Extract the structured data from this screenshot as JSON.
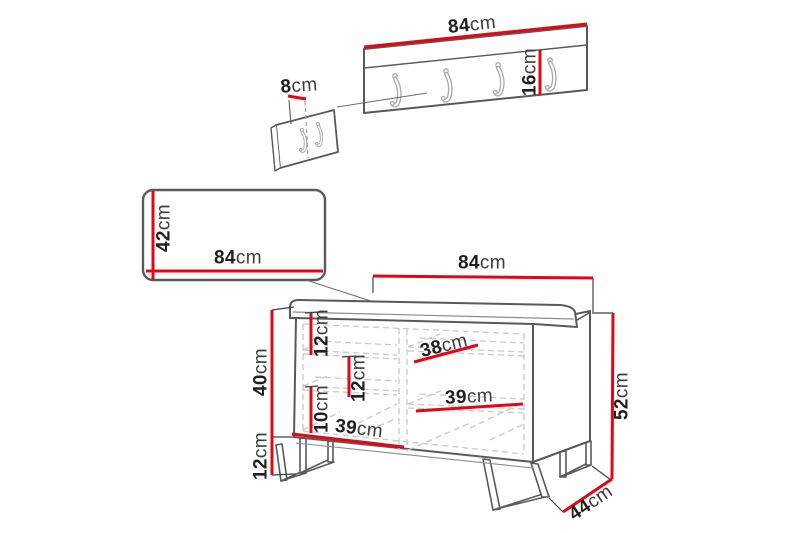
{
  "figure": {
    "description": "Hallway furniture set dimension diagram: wall coat rack, wall panel and shoe bench",
    "colors": {
      "dimension_line": "#e30613",
      "outline": "#58595b",
      "hidden_line": "#c7c8ca",
      "text": "#231f20"
    },
    "unit": "cm"
  },
  "labels": {
    "rack_width": {
      "value": "84",
      "unit": "cm"
    },
    "rack_height": {
      "value": "16",
      "unit": "cm"
    },
    "rack_depth": {
      "value": "8",
      "unit": "cm"
    },
    "mirror_height": {
      "value": "42",
      "unit": "cm"
    },
    "mirror_width": {
      "value": "84",
      "unit": "cm"
    },
    "bench_width": {
      "value": "84",
      "unit": "cm"
    },
    "bench_height": {
      "value": "52",
      "unit": "cm"
    },
    "bench_depth": {
      "value": "44",
      "unit": "cm"
    },
    "bench_body_height": {
      "value": "40",
      "unit": "cm"
    },
    "bench_leg_height": {
      "value": "12",
      "unit": "cm"
    },
    "shelf_gap_top": {
      "value": "12",
      "unit": "cm"
    },
    "shelf_gap_mid": {
      "value": "12",
      "unit": "cm"
    },
    "shelf_gap_low": {
      "value": "10",
      "unit": "cm"
    },
    "shelf_left_width": {
      "value": "39",
      "unit": "cm"
    },
    "shelf_right_top": {
      "value": "38",
      "unit": "cm"
    },
    "shelf_right_mid": {
      "value": "39",
      "unit": "cm"
    }
  }
}
